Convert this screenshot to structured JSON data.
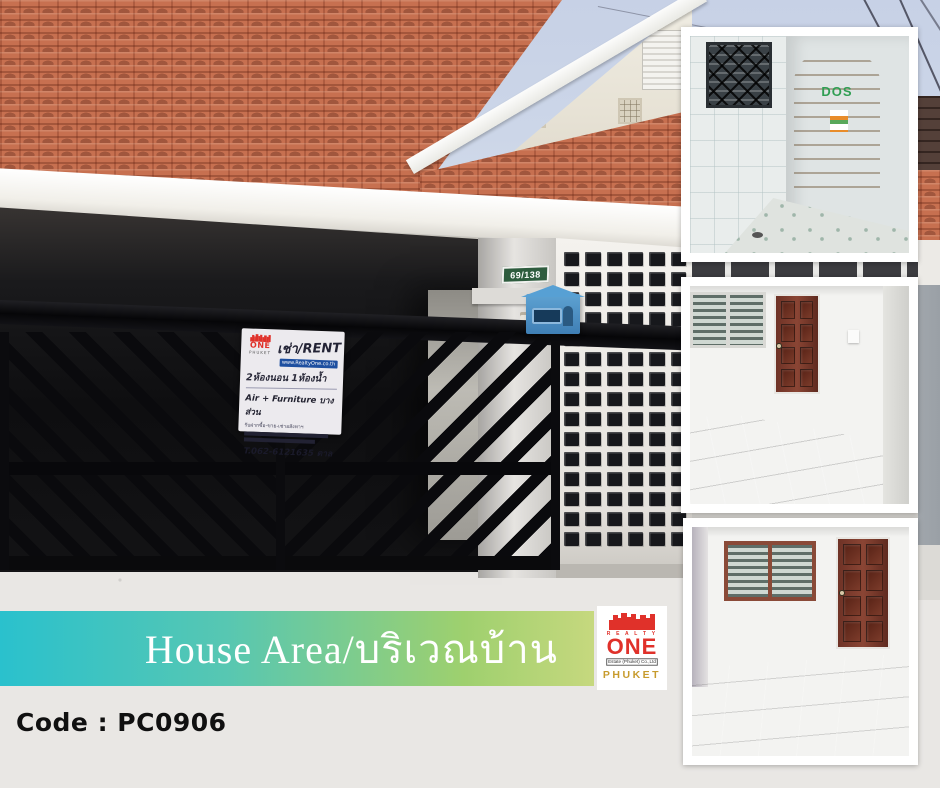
{
  "page": {
    "background": "#e9e7e4"
  },
  "banner": {
    "title": "House Area/บริเวณบ้าน",
    "gradient_start": "#2ac1cd",
    "gradient_mid": "#6cc9a0",
    "gradient_end": "#c6d87e",
    "text_color": "#ffffff"
  },
  "property": {
    "code_label": "Code : PC0906",
    "house_number": "69/138"
  },
  "brand": {
    "realty": "R E A L T Y",
    "one": "ONE",
    "estate_line": "Estate (Phuket) Co.,Ltd",
    "phuket": "PHUKET",
    "red": "#e0312a",
    "gold": "#c79b2d"
  },
  "rent_sign": {
    "title": "เช่า/RENT",
    "website": "www.RealtyOne.co.th",
    "rooms_line": "2ห้องนอน 1ห้องน้ำ",
    "features_line": "Air + Furniture บางส่วน",
    "services_line": "รับฝากซื้อ-ขาย-เช่าอสังหาฯ",
    "phone_line": "T.062-6121635 ตาล"
  },
  "insets": {
    "utility": {
      "tank_brand": "DOS"
    }
  }
}
